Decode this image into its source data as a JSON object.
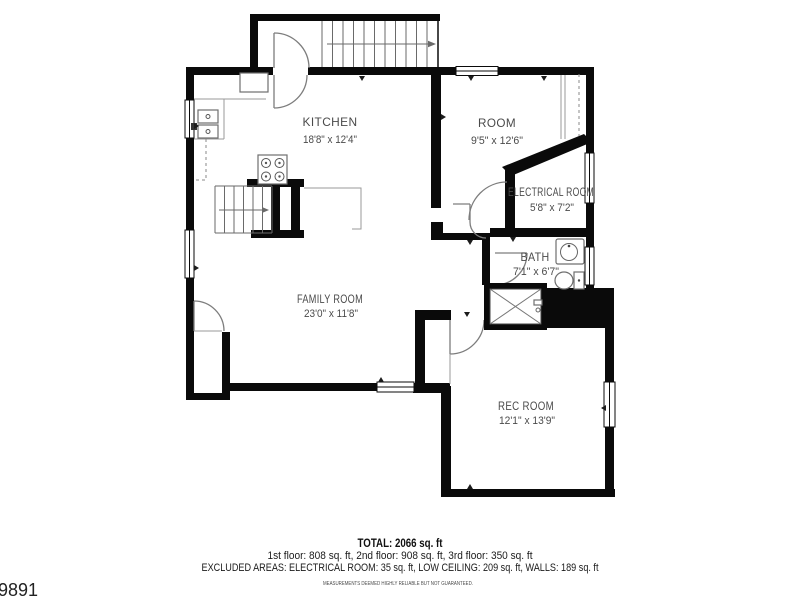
{
  "plan": {
    "rooms": [
      {
        "name": "KITCHEN",
        "dims": "18'8\" x 12'4\""
      },
      {
        "name": "ROOM",
        "dims": "9'5\" x 12'6\""
      },
      {
        "name": "ELECTRICAL ROOM",
        "dims": "5'8\" x 7'2\""
      },
      {
        "name": "BATH",
        "dims": "7'1\" x 6'7\""
      },
      {
        "name": "FAMILY ROOM",
        "dims": "23'0\" x 11'8\""
      },
      {
        "name": "REC ROOM",
        "dims": "12'1\" x 13'9\""
      }
    ],
    "summary": {
      "total": "TOTAL: 2066 sq. ft",
      "floors": "1st floor: 808 sq. ft, 2nd floor: 908 sq. ft, 3rd floor: 350 sq. ft",
      "excluded": "EXCLUDED AREAS: ELECTRICAL ROOM: 35 sq. ft, LOW CEILING: 209 sq. ft, WALLS: 189 sq. ft",
      "disclaimer": "MEASUREMENTS DEEMED HIGHLY RELIABLE BUT NOT GUARANTEED."
    },
    "listing_id": "5389891"
  }
}
